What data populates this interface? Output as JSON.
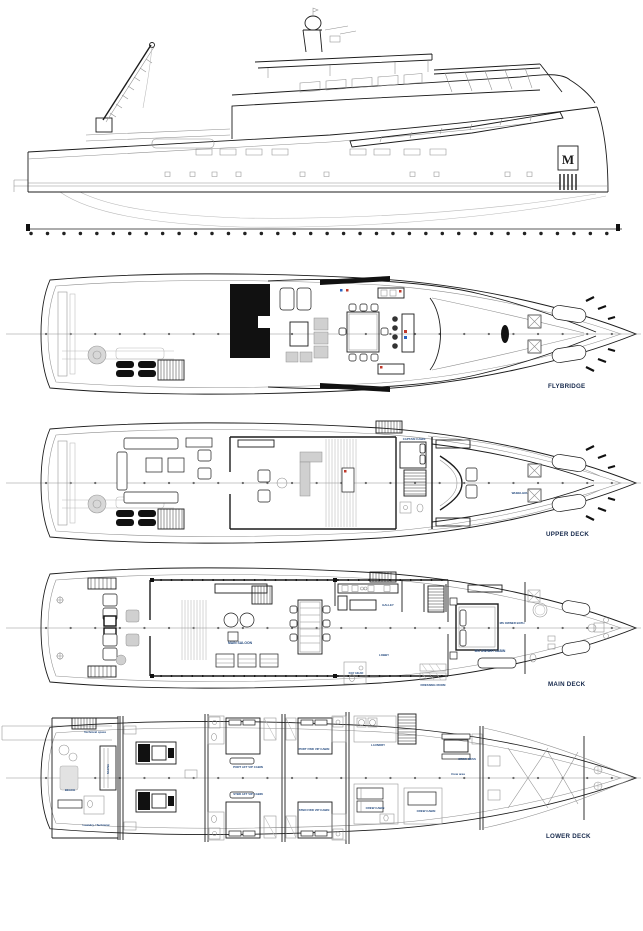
{
  "profile": {
    "logo_letter": "M"
  },
  "decks": {
    "flybridge": {
      "label": "FLYBRIDGE"
    },
    "upper": {
      "label": "UPPER DECK",
      "rooms": {
        "captain_cabin": "CAPTAIN CABIN",
        "wheelhouse": "WHEELHOUSE"
      }
    },
    "main": {
      "label": "MAIN DECK",
      "rooms": {
        "main_saloon": "MAIN SALOON",
        "galley": "GALLEY",
        "lobby": "LOBBY",
        "day_head": "DAY HEAD",
        "dressing_room": "DRESSING ROOM",
        "owner_cabin": "MS OWNER CABIN",
        "owner_bath": "MS OWNER BATH"
      }
    },
    "lower": {
      "label": "LOWER DECK",
      "rooms": {
        "beach": "BEACH",
        "sauna": "SAUNA",
        "technical_space": "Technical space",
        "laundry_technical": "Laundry / Technical",
        "laundry": "LAUNDRY",
        "crew_mess": "CREW MESS",
        "crew_area": "Crew area",
        "crew_cabin_1": "CREW CABIN",
        "crew_cabin_2": "CREW CABIN",
        "vip_port_aft": "PORT AFT VIP CABIN",
        "vip_stbd_aft": "STBD AFT VIP CABIN",
        "vip_port_fwd": "PORT FWD VIP CABIN",
        "vip_stbd_fwd": "STBD FWD VIP CABIN"
      }
    }
  },
  "colors": {
    "line": "#1c1c1c",
    "secondary_line": "#8f8f8f",
    "fill_dark": "#111111",
    "fill_gray": "#d0d0d0",
    "label_navy": "#23497e",
    "deck_label_navy": "#15284b",
    "accent_red": "#c0392b",
    "accent_blue": "#2963c0",
    "background": "#ffffff"
  }
}
